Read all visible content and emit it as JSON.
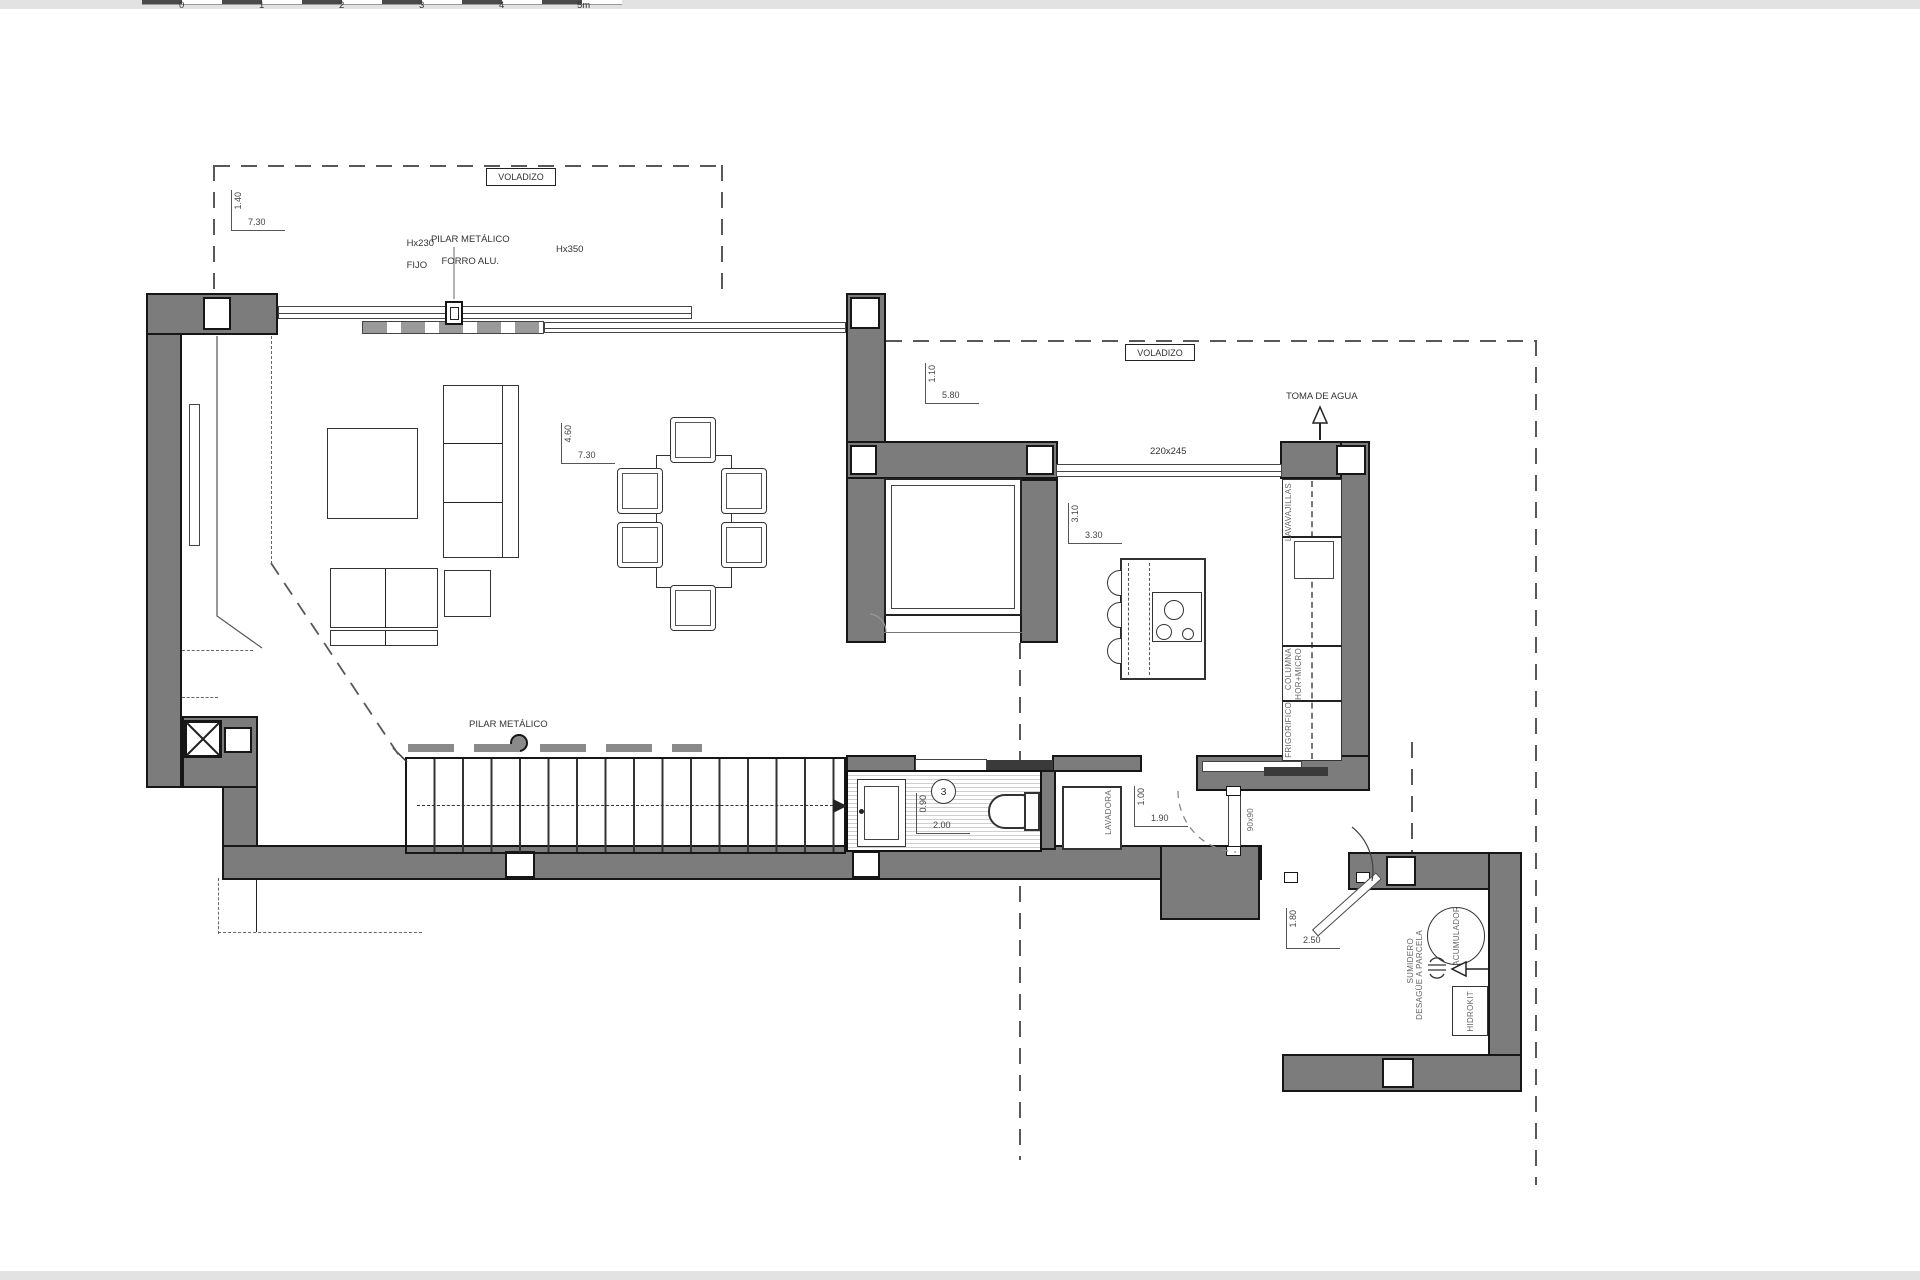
{
  "scale_bar": {
    "ticks": [
      "0",
      "1",
      "2",
      "3",
      "4",
      "5m"
    ]
  },
  "annotations": {
    "voladizo_left": "VOLADIZO",
    "voladizo_right": "VOLADIZO",
    "pilar_line1": "PILAR METÁLICO",
    "pilar_line2": "FORRO ALU.",
    "hx230_line1": "Hx230",
    "hx230_line2": "FIJO",
    "hx350": "Hx350",
    "window_kitchen": "220x245",
    "toma_de_agua": "TOMA DE AGUA",
    "pilar_metalico": "PILAR METÁLICO",
    "bath_number": "3",
    "window_90": "90x90"
  },
  "kitchen": {
    "lavavajillas": "LAVAVAJILLAS",
    "columna_line1": "COLUMNA",
    "columna_line2": "HOR+MICRO",
    "frigorifico": "FRIGORIFICO"
  },
  "laundry": {
    "lavadora": "LAVADORA"
  },
  "tech_room": {
    "acumulador": "ACUMULADOR",
    "sumidero_line1": "SUMIDERO",
    "sumidero_line2": "DESAGÜE A PARCELA",
    "hidrokit": "HIDROKIT"
  },
  "dims": [
    {
      "id": "voladizo-left",
      "v": "1.40",
      "h": "7.30"
    },
    {
      "id": "voladizo-right",
      "v": "1.10",
      "h": "5.80"
    },
    {
      "id": "living",
      "v": "4.60",
      "h": "7.30"
    },
    {
      "id": "kitchen",
      "v": "3.10",
      "h": "3.30"
    },
    {
      "id": "bathroom",
      "v": "0.90",
      "h": "2.00"
    },
    {
      "id": "laundry",
      "v": "1.00",
      "h": "1.90"
    },
    {
      "id": "tech-room",
      "v": "1.80",
      "h": "2.50"
    }
  ],
  "colors": {
    "wall": "#7c7c7c",
    "outline": "#161616",
    "dash": "#585858",
    "hatch": "#cfcfcf"
  }
}
